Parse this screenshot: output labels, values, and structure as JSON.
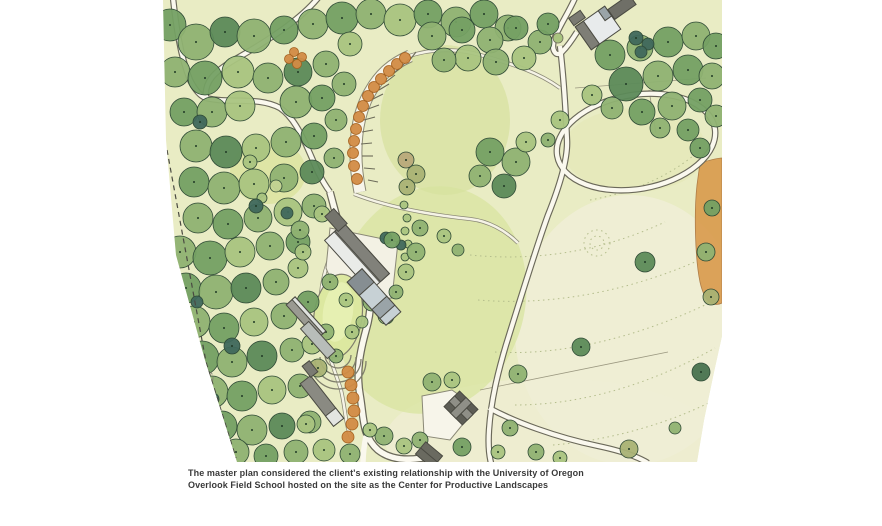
{
  "caption": {
    "line1": "The master plan considered the client's existing relationship with the University of Oregon",
    "line2": "Overlook Field School hosted on the site as the Center for Productive Landscapes"
  },
  "illustration": {
    "title": "Overlook Field School master plan watercolor site illustration",
    "palette": {
      "page_background": "#ffffff",
      "meadow_base": "#e9ecc4",
      "meadow_pale": "#f0eed6",
      "grass_mid": "#d9e5a2",
      "forest_light": "#a9c47f",
      "forest_dark": "#48724f",
      "accent_teal": "#3f685c",
      "orchard_orange": "#d28b44",
      "road_fill": "#faf8ee",
      "road_edge": "#6b695a",
      "building_gray": "#77776f",
      "building_white": "#e9ebe8",
      "caption_text": "#3a3a3a"
    }
  }
}
